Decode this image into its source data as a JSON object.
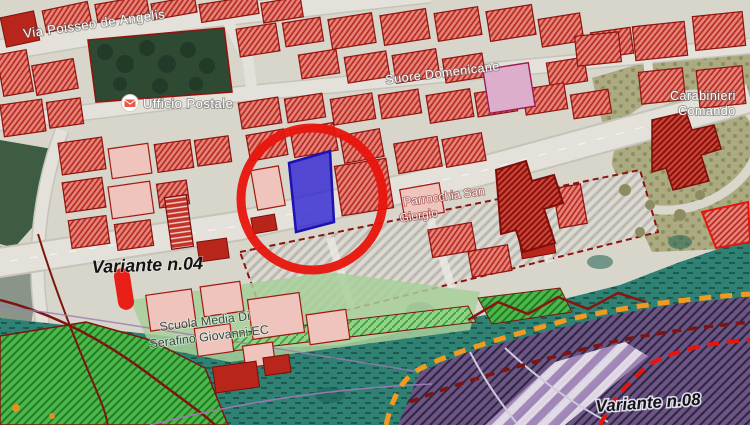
{
  "map": {
    "labels": {
      "street_top": "Via Poisseo de Angelis",
      "convent": "Suore Domenicane",
      "post_office": "Ufficio Postale",
      "carabinieri_1": "Carabinieri",
      "carabinieri_2": "Comando",
      "parish_1": "Parrocchia San",
      "parish_2": "Giorgio",
      "school_1": "Scuola Media Di",
      "school_2": "Serafino Giovanni EC",
      "variante_04": "Variante n.04",
      "variante_08": "Variante n.08"
    },
    "annotations": {
      "selection_circle_color": "#e8150d",
      "selected_parcel_color": "#2a1fd4",
      "variante_marker_color": "#e8150d"
    },
    "zone_colors": {
      "base_urban": "#d8d5cb",
      "building_red": "#e4837a",
      "building_outline": "#8f1410",
      "vegetation_teal": "#2f8173",
      "green_hatch": "#4db84a",
      "purple_zone": "#745087",
      "orange_boundary": "#f29a1f",
      "dark_red_boundary": "#7d1410",
      "olive_area": "#abaa80",
      "road": "#e3e1d9"
    },
    "icons": {
      "post_office_icon": "envelope"
    }
  }
}
